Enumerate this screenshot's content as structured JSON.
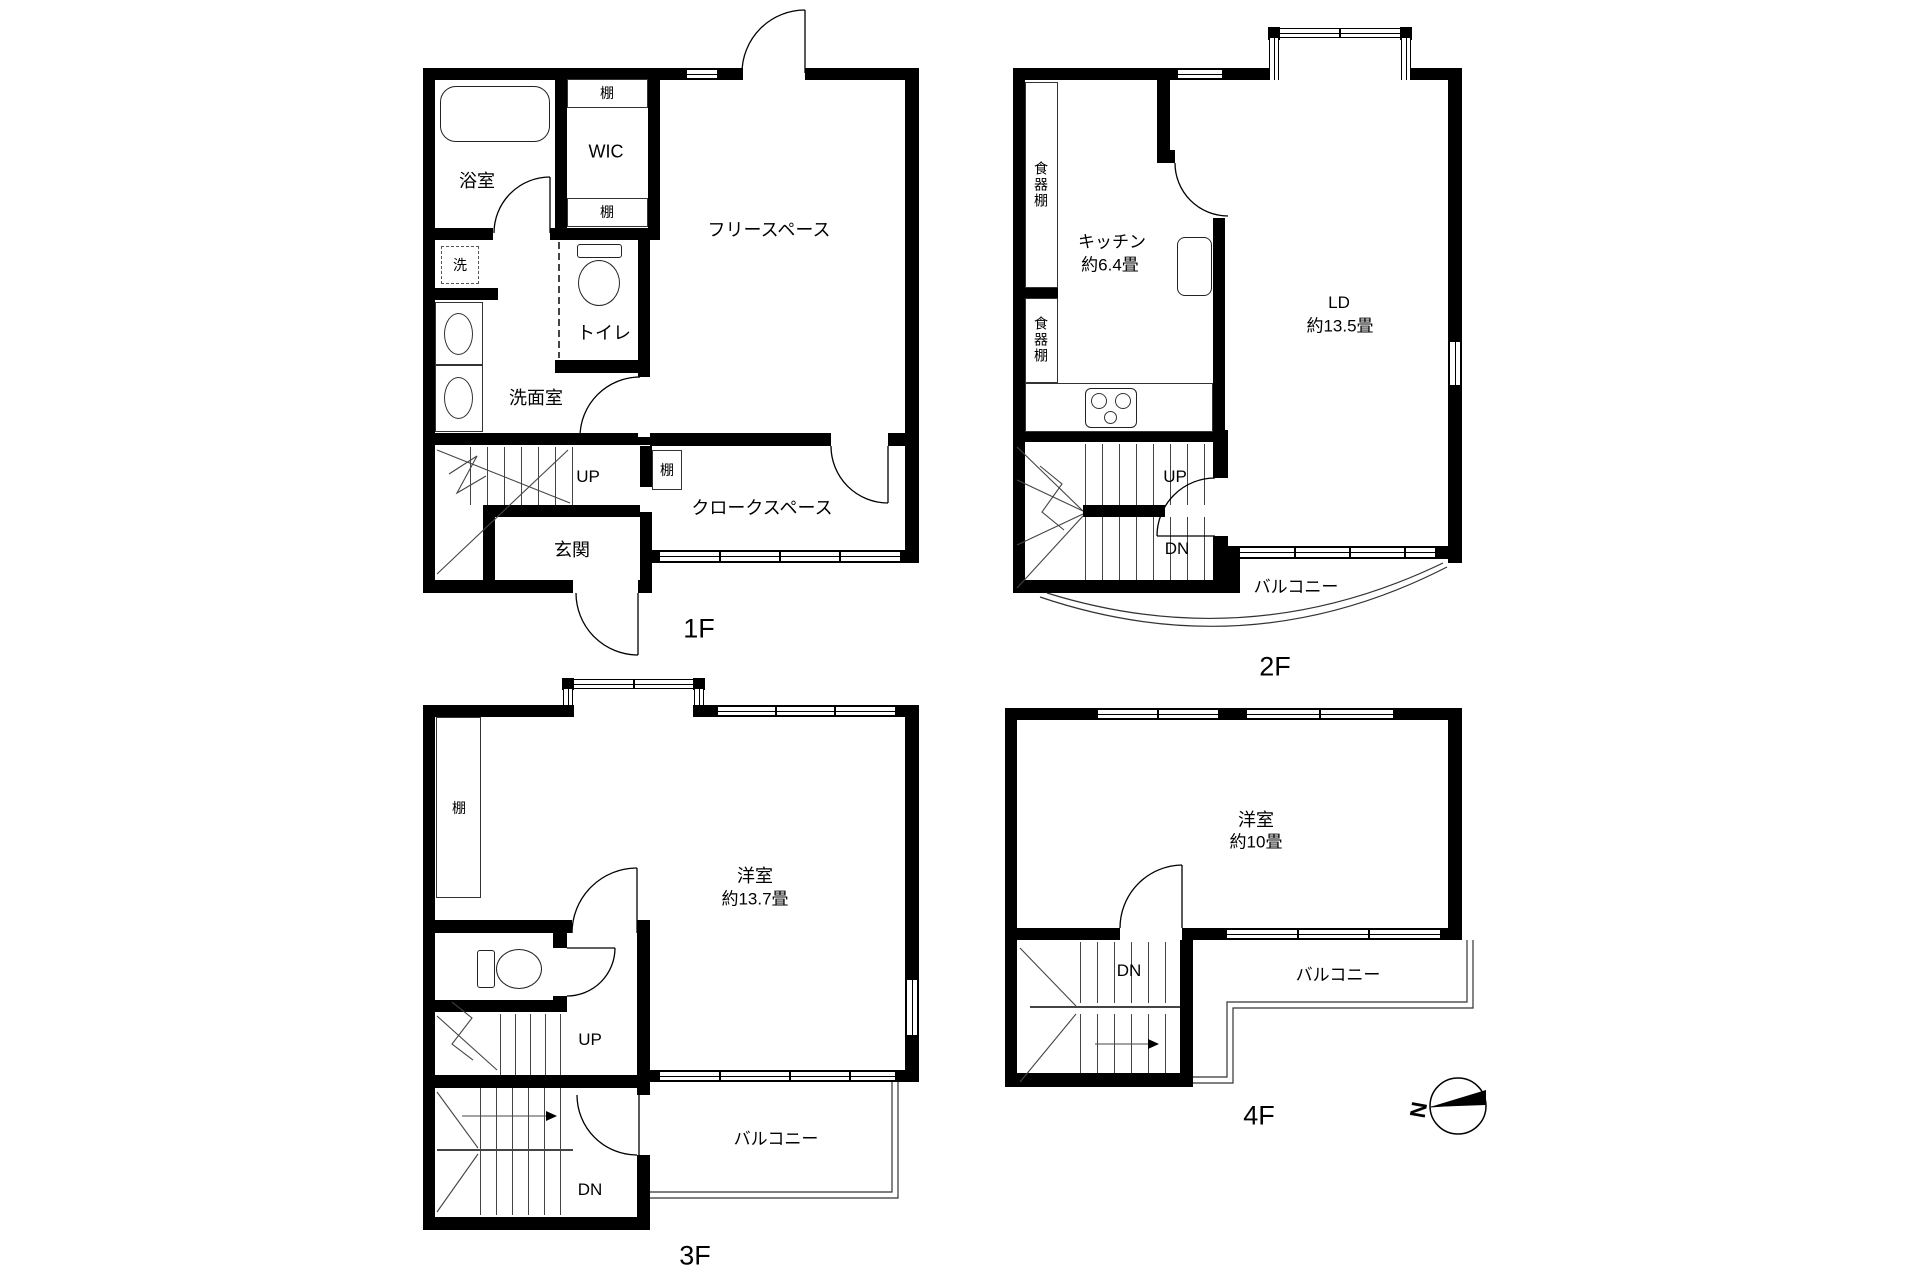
{
  "floors": {
    "f1": {
      "label": "1F",
      "bath": "浴室",
      "shelf_top": "棚",
      "wic": "WIC",
      "shelf_mid": "棚",
      "laundry": "洗",
      "toilet": "トイレ",
      "powder_room": "洗面室",
      "free_space": "フリースペース",
      "up": "UP",
      "entrance": "玄関",
      "shelf_cloak": "棚",
      "cloak_space": "クロークスペース"
    },
    "f2": {
      "label": "2F",
      "cupboard_top": "食器棚",
      "cupboard_bottom": "食器棚",
      "kitchen": "キッチン",
      "kitchen_size": "約6.4畳",
      "living": "LD",
      "living_size": "約13.5畳",
      "up": "UP",
      "down": "DN",
      "balcony": "バルコニー"
    },
    "f3": {
      "label": "3F",
      "shelf": "棚",
      "room": "洋室",
      "room_size": "約13.7畳",
      "up": "UP",
      "down": "DN",
      "balcony": "バルコニー"
    },
    "f4": {
      "label": "4F",
      "room": "洋室",
      "room_size": "約10畳",
      "down": "DN",
      "balcony": "バルコニー",
      "compass_north": "N"
    }
  }
}
